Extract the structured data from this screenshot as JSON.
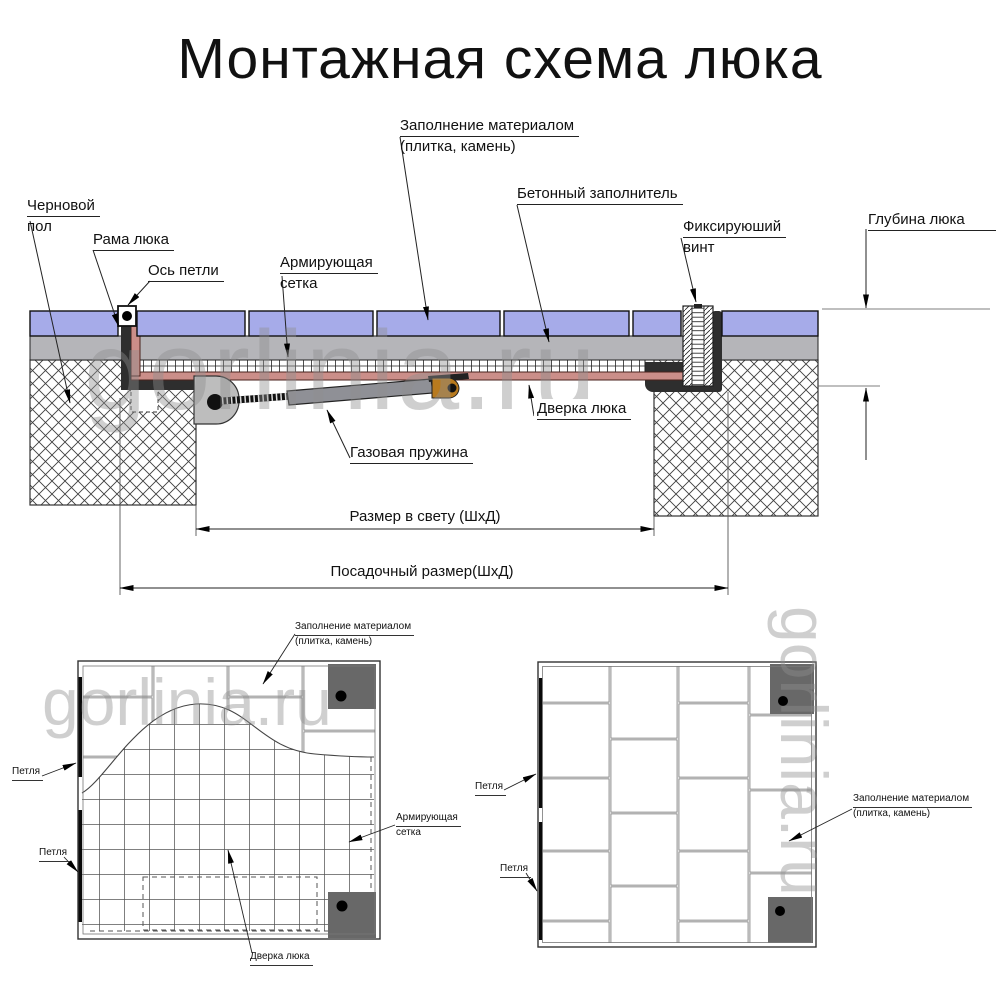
{
  "title": "Монтажная схема люка",
  "watermark": "gorlinia.ru",
  "section": {
    "labels": {
      "subfloor": {
        "line1": "Черновой",
        "line2": "пол"
      },
      "frame": {
        "line1": "Рама люка"
      },
      "hinge_axis": {
        "line1": "Ось петли"
      },
      "mesh": {
        "line1": "Армирующая",
        "line2": "сетка"
      },
      "fill_material": {
        "line1": "Заполнение материалом",
        "line2": "(плитка, камень)"
      },
      "concrete": {
        "line1": "Бетонный заполнитель"
      },
      "fix_screw": {
        "line1": "Фиксируюший",
        "line2": "винт"
      },
      "depth": {
        "line1": "Глубина люка"
      },
      "door": {
        "line1": "Дверка люка"
      },
      "gas_spring": {
        "line1": "Газовая пружина"
      }
    },
    "dimensions": {
      "clear_size": "Размер в свету (ШхД)",
      "mounting_size": "Посадочный размер(ШхД)"
    }
  },
  "plan_left": {
    "labels": {
      "fill_material": {
        "line1": "Заполнение материалом",
        "line2": "(плитка, камень)"
      },
      "hinge_top": {
        "line1": "Петля"
      },
      "hinge_bottom": {
        "line1": "Петля"
      },
      "mesh": {
        "line1": "Армирующая",
        "line2": "сетка"
      },
      "door": {
        "line1": "Дверка люка"
      }
    }
  },
  "plan_right": {
    "labels": {
      "hinge_top": {
        "line1": "Петля"
      },
      "hinge_bottom": {
        "line1": "Петля"
      },
      "fill_material": {
        "line1": "Заполнение материалом",
        "line2": "(плитка, камень)"
      }
    }
  },
  "colors": {
    "tile": "#a6abe9",
    "screed": "#b5b5b9",
    "door_pan": "#cb8e89",
    "frame": "#2e2e2e",
    "spring_body": "#8f9096",
    "bracket": "#b87a1e",
    "hinge_housing": "#bdbdbd",
    "plan_corner_block": "#686868",
    "watermark": "#8f8f8f"
  }
}
